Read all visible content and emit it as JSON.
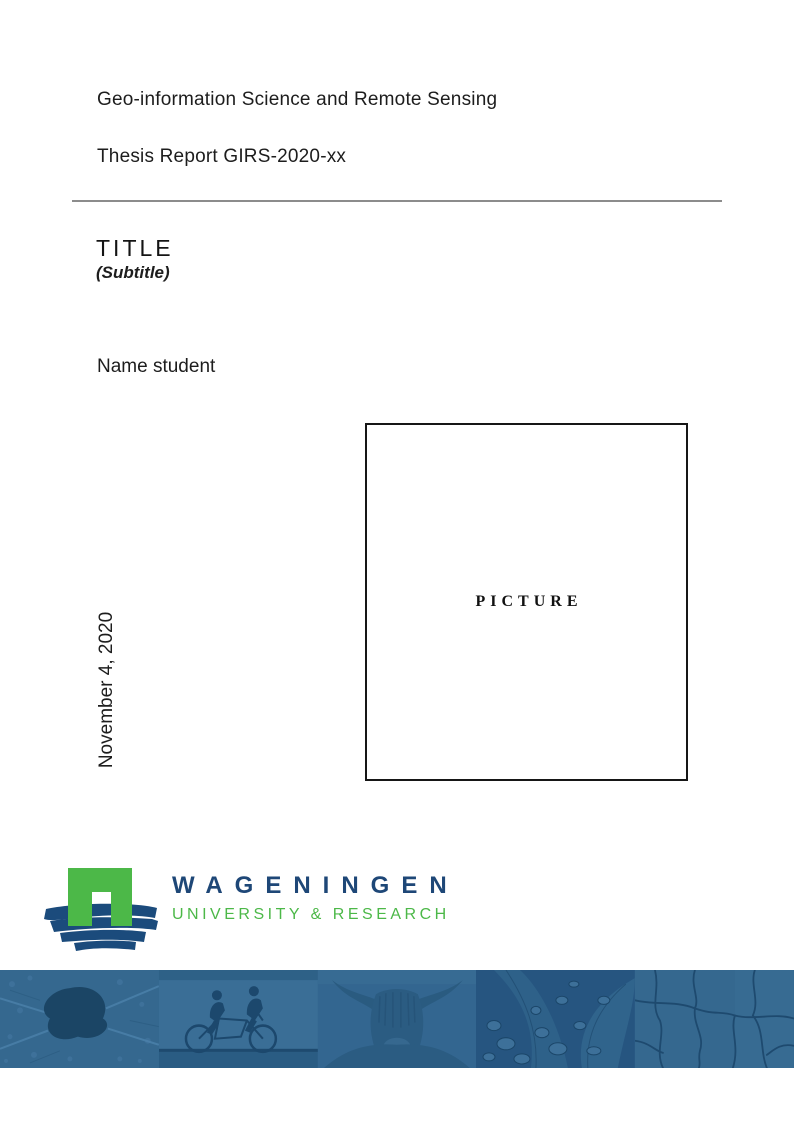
{
  "document": {
    "program": "Geo-information Science and Remote Sensing",
    "report_id": "Thesis Report GIRS-2020-xx",
    "title": "TITLE",
    "subtitle": "(Subtitle)",
    "author": "Name student",
    "date": "November 4, 2020",
    "picture_placeholder": "PICTURE"
  },
  "logo": {
    "org": "WAGENINGEN",
    "tagline": "UNIVERSITY & RESEARCH",
    "colors": {
      "brand_green": "#4CB848",
      "brand_blue": "#1E4777",
      "banner_blue": "#35688F"
    }
  },
  "banner": {
    "photos": [
      {
        "name": "aerial-landscape"
      },
      {
        "name": "tandem-cyclists"
      },
      {
        "name": "highland-cow"
      },
      {
        "name": "leaf-water-droplets"
      },
      {
        "name": "cracked-earth"
      }
    ]
  }
}
